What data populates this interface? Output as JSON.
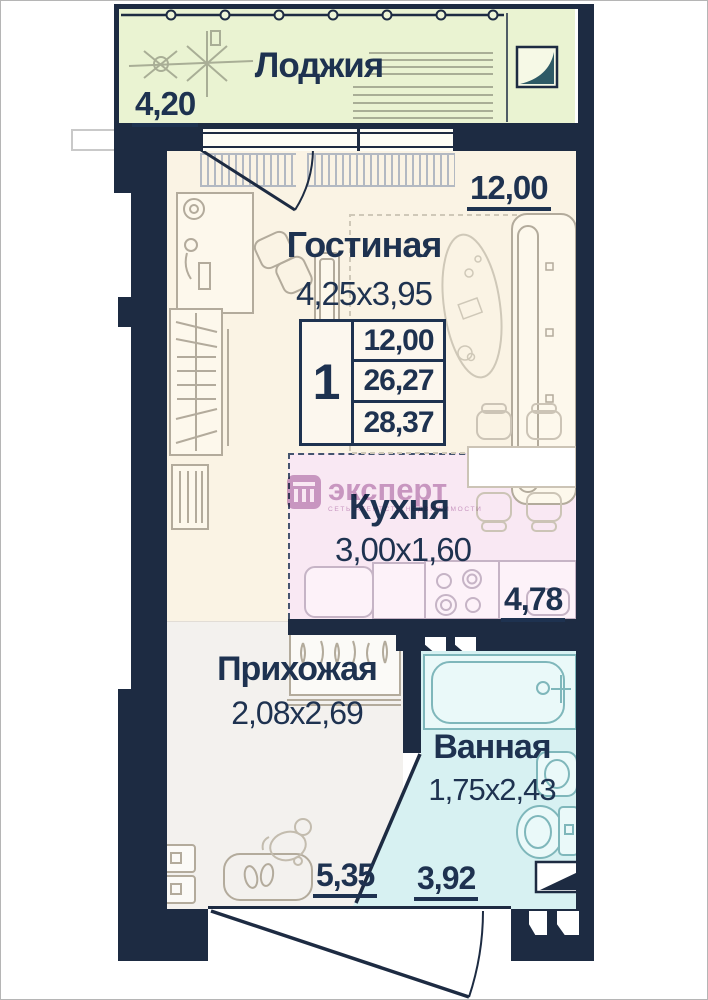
{
  "plan_title": "floor-plan",
  "info_table": {
    "unit_count": "1",
    "rows": [
      "12,00",
      "26,27",
      "28,37"
    ]
  },
  "rooms": {
    "loggia": {
      "label": "Лоджия",
      "area": "4,20"
    },
    "living": {
      "label": "Гостиная",
      "dims": "4,25x3,95",
      "area": "12,00"
    },
    "kitchen": {
      "label": "Кухня",
      "dims": "3,00x1,60",
      "area": "4,78"
    },
    "hall": {
      "label": "Прихожая",
      "dims": "2,08x2,69",
      "area": "5,35"
    },
    "bath": {
      "label": "Ванная",
      "dims": "1,75x2,43",
      "area": "3,92"
    }
  },
  "watermark": {
    "brand": "эксперт",
    "tagline": "СЕТЬ АГЕНТСТВ НЕДВИЖИМОСТИ"
  },
  "colors": {
    "wall": "#1d2b42",
    "ink": "#1e3250",
    "loggia_bg": "#eaf3d2",
    "living_bg": "#faf3e4",
    "kitchen_bg": "#f9e8f3",
    "hall_bg": "#f3f1ee",
    "bath_bg": "#d7f1f2",
    "watermark": "#a964a4"
  }
}
